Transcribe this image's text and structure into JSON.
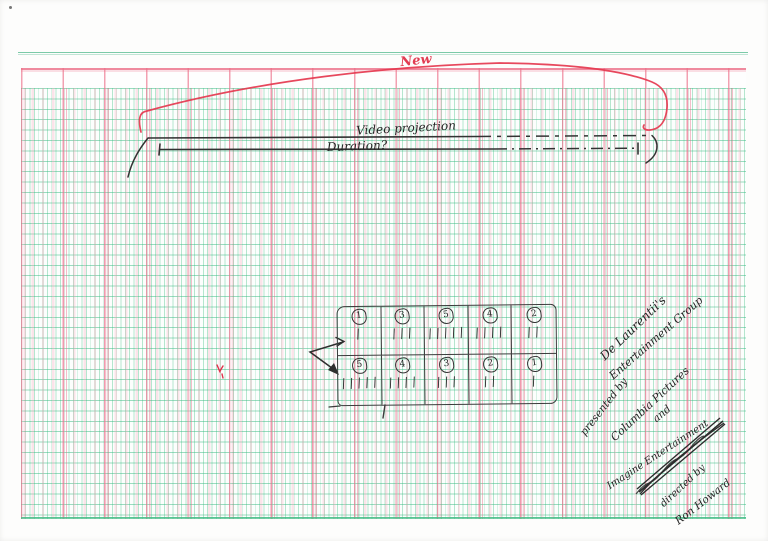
{
  "labels": {
    "new": "New",
    "video_projection": "Video projection",
    "duration": "Duration?"
  },
  "tally_table": {
    "top_row": [
      {
        "number": "1",
        "tally": "|"
      },
      {
        "number": "3",
        "tally": "|||"
      },
      {
        "number": "5",
        "tally": "|||||"
      },
      {
        "number": "4",
        "tally": "||||"
      },
      {
        "number": "2",
        "tally": "||"
      }
    ],
    "bottom_row": [
      {
        "number": "5",
        "tally": "|||||"
      },
      {
        "number": "4",
        "tally": "||||"
      },
      {
        "number": "3",
        "tally": "|||"
      },
      {
        "number": "2",
        "tally": "||"
      },
      {
        "number": "1",
        "tally": "|"
      }
    ]
  },
  "credits": {
    "lines": [
      "De Laurentii's",
      "Entertainment Group",
      "presented by",
      "Columbia Pictures",
      "and",
      "Imagine Entertainment",
      "directed by",
      "Ron Howard"
    ]
  },
  "colors": {
    "red_ink": "#e23c52",
    "black_ink": "#2b2b2b",
    "grid_green": "#5fc39a",
    "grid_pink": "#ee7d95"
  }
}
